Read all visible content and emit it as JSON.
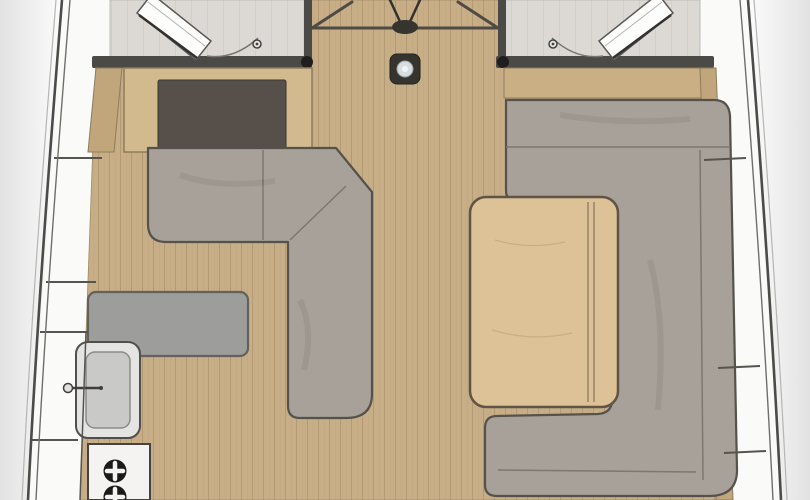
{
  "plan": {
    "type": "yacht-interior-floorplan",
    "view": "top-down saloon and galley"
  },
  "legend": {
    "hull": "hull outline",
    "side_decks": "side deck locker panels",
    "aft_cabins": "two cabin entrances with swinging doors",
    "companionway": "companionway steps",
    "mast_base": "mast base fitting",
    "port_sofa": "L-shaped port settee",
    "nav_desk": "chart table with dark panel",
    "galley_counter": "galley counter",
    "sink": "galley sink with faucet",
    "stove": "two-burner stove",
    "starboard_dinette": "U-shaped starboard settee",
    "saloon_table": "saloon table with leaf hinge",
    "floor": "teak plank cabin sole",
    "shelf": "starboard shelf trim"
  },
  "palette": {
    "background": "#ffffff",
    "vignette": "#d8d8d8",
    "hull_line": "#4b4b49",
    "hull_line_inner": "#6f6e6c",
    "hull_line_outer": "#b5b5b3",
    "deck_panel": "#fafaf9",
    "deck_divider": "#56544f",
    "cabin_floor": "#dcd9d5",
    "wall": "#4b4a47",
    "hinge_dot": "#1f1e1c",
    "floor_plank": "#c7ae86",
    "floor_plank_line": "#b0976f",
    "wood_furniture": "#d2ba8e",
    "wood_shelf": "#c9af83",
    "wood_trim": "#c0a67a",
    "wood_table": "#dcc296",
    "wood_edge": "#8d7c5e",
    "desk_panel": "#57504a",
    "sofa_fill": "#a7a199",
    "sofa_edge": "#55524c",
    "sofa_seam": "#7c776f",
    "counter": "#9d9d9b",
    "counter_edge": "#63615d",
    "sink_outer": "#e4e4e2",
    "sink_basin": "#c9c9c7",
    "stove_body": "#f4f3f1",
    "burner": "#1b1a18",
    "fitting_dark": "#36342f",
    "fitting_light": "#d9dde0",
    "door_leaf": "#fdfdfc",
    "door_edge": "#33312f",
    "steps_line": "#4f4b44"
  }
}
